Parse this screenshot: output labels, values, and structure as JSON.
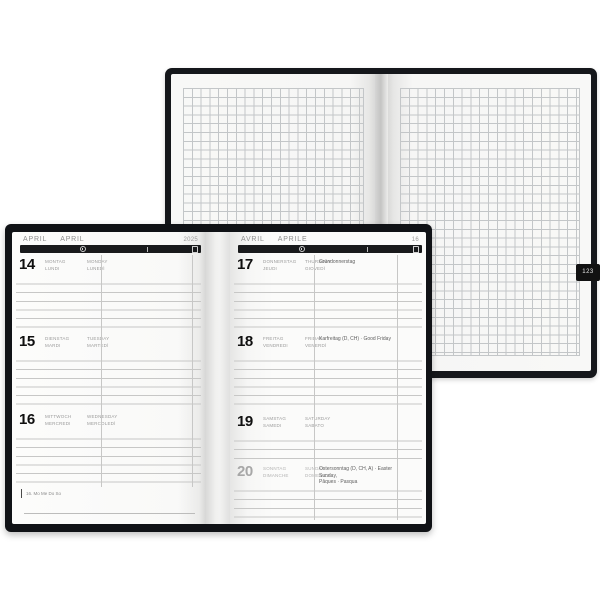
{
  "back_notebook": {
    "page_tab": "123"
  },
  "planner": {
    "left_page": {
      "header": {
        "m1": "APRIL",
        "m2": "APRIL",
        "right": "2025"
      },
      "days": [
        {
          "num": "14",
          "names": [
            "MONTAG",
            "MONDAY",
            "LUNDI",
            "LUNEDÌ"
          ],
          "holiday_lines": []
        },
        {
          "num": "15",
          "names": [
            "DIENSTAG",
            "TUESDAY",
            "MARDI",
            "MARTEDÌ"
          ],
          "holiday_lines": []
        },
        {
          "num": "16",
          "names": [
            "MITTWOCH",
            "WEDNESDAY",
            "MERCREDI",
            "MERCOLEDÌ"
          ],
          "holiday_lines": []
        }
      ],
      "footer_info": "16. Mo Me Do So"
    },
    "right_page": {
      "header": {
        "m1": "AVRIL",
        "m2": "APRILE",
        "right": "16"
      },
      "days": [
        {
          "num": "17",
          "names": [
            "DONNERSTAG",
            "THURSDAY",
            "JEUDI",
            "GIOVEDÌ"
          ],
          "holiday_lines": [
            "Gründonnerstag"
          ]
        },
        {
          "num": "18",
          "names": [
            "FREITAG",
            "FRIDAY",
            "VENDREDI",
            "VENERDÌ"
          ],
          "holiday_lines": [
            "Karfreitag (D, CH) · Good Friday"
          ]
        },
        {
          "num": "19",
          "names": [
            "SAMSTAG",
            "SATURDAY",
            "SAMEDI",
            "SABATO"
          ],
          "holiday_lines": []
        },
        {
          "num": "20",
          "names": [
            "SONNTAG",
            "SUNDAY",
            "DIMANCHE",
            "DOMENICA"
          ],
          "holiday_lines": [
            "Ostersonntag (D, CH, A) · Easter Sunday,",
            "Pâques · Pasqua"
          ],
          "muted": true
        }
      ]
    }
  },
  "colors": {
    "cover": "#15171b",
    "header_bar": "#191a1c",
    "ruled_line": "#c7c7c6",
    "grid_line": "#c3c6c8",
    "day_number": "#101010",
    "muted_day_number": "#a7a7a7",
    "day_name_text": "#9b9b9b",
    "holiday_text": "#5e5e5e"
  }
}
